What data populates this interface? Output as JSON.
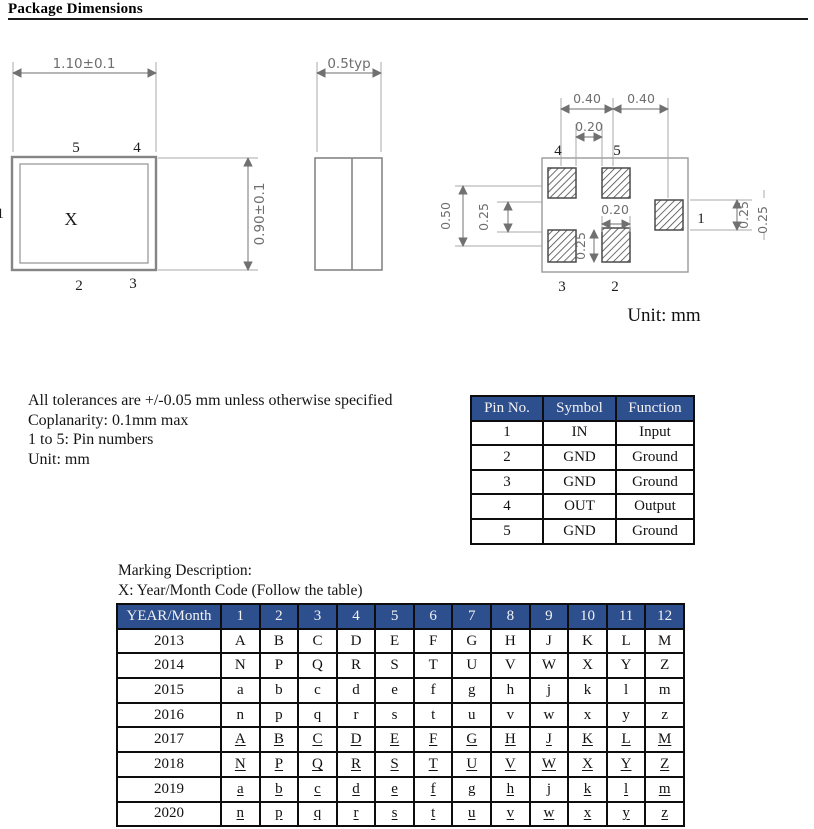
{
  "page": {
    "title": "Package Dimensions"
  },
  "colors": {
    "table_header_bg": "#2e4f8e",
    "table_header_text": "#f2f2f2"
  },
  "drawings": {
    "unit_label": "Unit: mm",
    "top_view": {
      "width_dim": "1.10±0.1",
      "height_dim": "0.90±0.1",
      "marking": "X",
      "pin_top_left": "5",
      "pin_top_right": "4",
      "pin_bottom_left": "2",
      "pin_bottom_right": "3",
      "pin_left": "1"
    },
    "side_view": {
      "thickness_dim": "0.5typ"
    },
    "land_pattern": {
      "dim_top_left": "0.40",
      "dim_top_right": "0.40",
      "dim_top_gap": "0.20",
      "pin4": "4",
      "pin5": "5",
      "dim_left_outer": "0.50",
      "dim_left_inner": "0.25",
      "dim_mid_width": "0.20",
      "dim_mid_height": "0.25",
      "pin1": "1",
      "dim_right_inner": "0.25",
      "dim_right_outer": "0.25",
      "pin3": "3",
      "pin2": "2"
    }
  },
  "notes": {
    "line1": "All tolerances are +/-0.05 mm unless otherwise specified",
    "line2": "Coplanarity: 0.1mm max",
    "line3": "1 to 5: Pin numbers",
    "line4": "Unit: mm"
  },
  "pin_table": {
    "headers": [
      "Pin No.",
      "Symbol",
      "Function"
    ],
    "rows": [
      {
        "cells": [
          "1",
          "IN",
          "Input"
        ]
      },
      {
        "cells": [
          "2",
          "GND",
          "Ground"
        ]
      },
      {
        "cells": [
          "3",
          "GND",
          "Ground"
        ]
      },
      {
        "cells": [
          "4",
          "OUT",
          "Output"
        ]
      },
      {
        "cells": [
          "5",
          "GND",
          "Ground"
        ]
      }
    ]
  },
  "marking": {
    "line1": "Marking Description:",
    "line2": "X: Year/Month Code (Follow the table)"
  },
  "year_table": {
    "headers": [
      "YEAR/Month",
      "1",
      "2",
      "3",
      "4",
      "5",
      "6",
      "7",
      "8",
      "9",
      "10",
      "11",
      "12"
    ],
    "rows": [
      {
        "cells": [
          "2013",
          "A",
          "B",
          "C",
          "D",
          "E",
          "F",
          "G",
          "H",
          "J",
          "K",
          "L",
          "M"
        ],
        "underlined": false
      },
      {
        "cells": [
          "2014",
          "N",
          "P",
          "Q",
          "R",
          "S",
          "T",
          "U",
          "V",
          "W",
          "X",
          "Y",
          "Z"
        ],
        "underlined": false
      },
      {
        "cells": [
          "2015",
          "a",
          "b",
          "c",
          "d",
          "e",
          "f",
          "g",
          "h",
          "j",
          "k",
          "l",
          "m"
        ],
        "underlined": false
      },
      {
        "cells": [
          "2016",
          "n",
          "p",
          "q",
          "r",
          "s",
          "t",
          "u",
          "v",
          "w",
          "x",
          "y",
          "z"
        ],
        "underlined": false
      },
      {
        "cells": [
          "2017",
          "A",
          "B",
          "C",
          "D",
          "E",
          "F",
          "G",
          "H",
          "J",
          "K",
          "L",
          "M"
        ],
        "underlined": true
      },
      {
        "cells": [
          "2018",
          "N",
          "P",
          "Q",
          "R",
          "S",
          "T",
          "U",
          "V",
          "W",
          "X",
          "Y",
          "Z"
        ],
        "underlined": true
      },
      {
        "cells": [
          "2019",
          "a",
          "b",
          "c",
          "d",
          "e",
          "f",
          "g",
          "h",
          "j",
          "k",
          "l",
          "m"
        ],
        "underlined": true
      },
      {
        "cells": [
          "2020",
          "n",
          "p",
          "q",
          "r",
          "s",
          "t",
          "u",
          "v",
          "w",
          "x",
          "y",
          "z"
        ],
        "underlined": true
      }
    ]
  }
}
